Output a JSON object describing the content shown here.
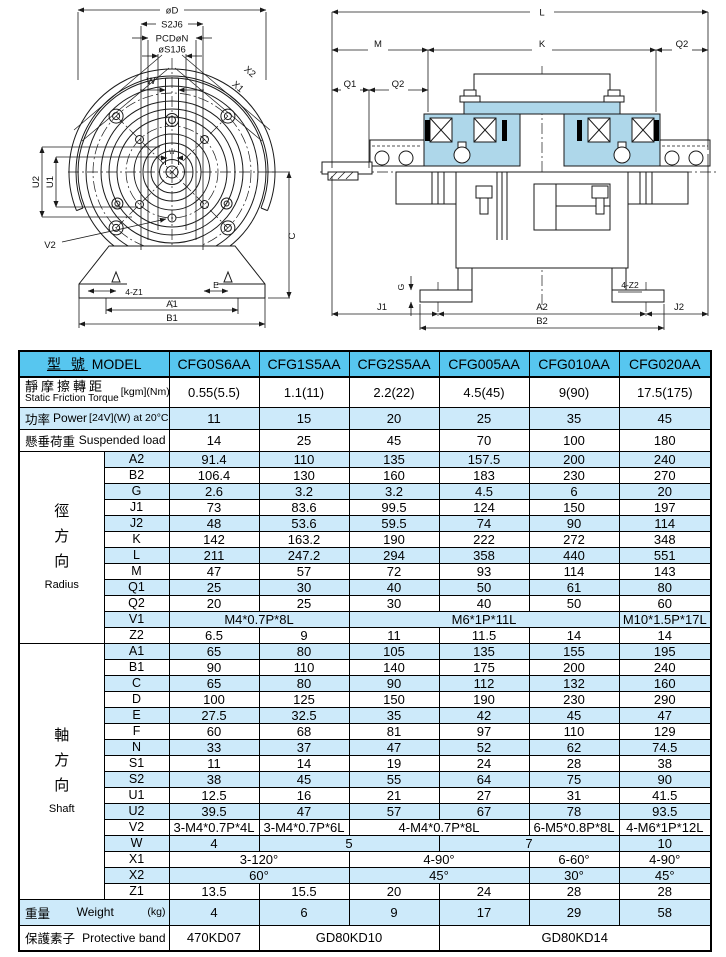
{
  "colors": {
    "header_blue": "#57c6ef",
    "row_blue": "#cdeafa",
    "drawing_fill": "#aed7ea"
  },
  "drawings": {
    "front_view": {
      "labels": {
        "od": "øD",
        "s2": "S2J6",
        "pcd": "PCDøN",
        "s1": "øS1J6",
        "w": "W",
        "w_small": "W",
        "x2": "X2",
        "x1": "X1",
        "u2": "U2",
        "u1": "U1",
        "v2": "V2",
        "c": "C",
        "z1": "4-Z1",
        "e": "E",
        "a1": "A1",
        "b1": "B1"
      }
    },
    "side_view": {
      "labels": {
        "l": "L",
        "m": "M",
        "k": "K",
        "q2_right": "Q2",
        "q1": "Q1",
        "q2_left": "Q2",
        "g": "G",
        "j1": "J1",
        "a2": "A2",
        "z2": "4-Z2",
        "j2": "J2",
        "b2": "B2"
      }
    }
  },
  "table": {
    "header": {
      "model_zh": "型 號",
      "model_en": "MODEL",
      "models": [
        "CFG0S6AA",
        "CFG1S5AA",
        "CFG2S5AA",
        "CFG005AA",
        "CFG010AA",
        "CFG020AA"
      ]
    },
    "spec_rows": [
      {
        "zh": "靜摩擦轉距",
        "en": "Static Friction Torque",
        "unit": "[kgm](Nm)",
        "two_line": true,
        "values": [
          "0.55(5.5)",
          "1.1(11)",
          "2.2(22)",
          "4.5(45)",
          "9(90)",
          "17.5(175)"
        ]
      },
      {
        "zh": "功率",
        "en": "Power",
        "unit": "[24V](W) at 20°C",
        "two_line": false,
        "values": [
          "11",
          "15",
          "20",
          "25",
          "35",
          "45"
        ]
      },
      {
        "zh": "懸垂荷重",
        "en": "Suspended load",
        "unit": "",
        "two_line": false,
        "values": [
          "14",
          "25",
          "45",
          "70",
          "100",
          "180"
        ]
      }
    ],
    "sections": [
      {
        "zh": "徑方向",
        "en": "Radius",
        "rows": [
          {
            "param": "A2",
            "cells": [
              [
                "91.4",
                1
              ],
              [
                "110",
                1
              ],
              [
                "135",
                1
              ],
              [
                "157.5",
                1
              ],
              [
                "200",
                1
              ],
              [
                "240",
                1
              ]
            ]
          },
          {
            "param": "B2",
            "cells": [
              [
                "106.4",
                1
              ],
              [
                "130",
                1
              ],
              [
                "160",
                1
              ],
              [
                "183",
                1
              ],
              [
                "230",
                1
              ],
              [
                "270",
                1
              ]
            ]
          },
          {
            "param": "G",
            "cells": [
              [
                "2.6",
                1
              ],
              [
                "3.2",
                1
              ],
              [
                "3.2",
                1
              ],
              [
                "4.5",
                1
              ],
              [
                "6",
                1
              ],
              [
                "20",
                1
              ]
            ]
          },
          {
            "param": "J1",
            "cells": [
              [
                "73",
                1
              ],
              [
                "83.6",
                1
              ],
              [
                "99.5",
                1
              ],
              [
                "124",
                1
              ],
              [
                "150",
                1
              ],
              [
                "197",
                1
              ]
            ]
          },
          {
            "param": "J2",
            "cells": [
              [
                "48",
                1
              ],
              [
                "53.6",
                1
              ],
              [
                "59.5",
                1
              ],
              [
                "74",
                1
              ],
              [
                "90",
                1
              ],
              [
                "114",
                1
              ]
            ]
          },
          {
            "param": "K",
            "cells": [
              [
                "142",
                1
              ],
              [
                "163.2",
                1
              ],
              [
                "190",
                1
              ],
              [
                "222",
                1
              ],
              [
                "272",
                1
              ],
              [
                "348",
                1
              ]
            ]
          },
          {
            "param": "L",
            "cells": [
              [
                "211",
                1
              ],
              [
                "247.2",
                1
              ],
              [
                "294",
                1
              ],
              [
                "358",
                1
              ],
              [
                "440",
                1
              ],
              [
                "551",
                1
              ]
            ]
          },
          {
            "param": "M",
            "cells": [
              [
                "47",
                1
              ],
              [
                "57",
                1
              ],
              [
                "72",
                1
              ],
              [
                "93",
                1
              ],
              [
                "114",
                1
              ],
              [
                "143",
                1
              ]
            ]
          },
          {
            "param": "Q1",
            "cells": [
              [
                "25",
                1
              ],
              [
                "30",
                1
              ],
              [
                "40",
                1
              ],
              [
                "50",
                1
              ],
              [
                "61",
                1
              ],
              [
                "80",
                1
              ]
            ]
          },
          {
            "param": "Q2",
            "cells": [
              [
                "20",
                1
              ],
              [
                "25",
                1
              ],
              [
                "30",
                1
              ],
              [
                "40",
                1
              ],
              [
                "50",
                1
              ],
              [
                "60",
                1
              ]
            ]
          },
          {
            "param": "V1",
            "cells": [
              [
                "M4*0.7P*8L",
                2
              ],
              [
                "M6*1P*11L",
                3
              ],
              [
                "M10*1.5P*17L",
                1
              ]
            ]
          },
          {
            "param": "Z2",
            "cells": [
              [
                "6.5",
                1
              ],
              [
                "9",
                1
              ],
              [
                "11",
                1
              ],
              [
                "11.5",
                1
              ],
              [
                "14",
                1
              ],
              [
                "14",
                1
              ]
            ]
          }
        ]
      },
      {
        "zh": "軸方向",
        "en": "Shaft",
        "rows": [
          {
            "param": "A1",
            "cells": [
              [
                "65",
                1
              ],
              [
                "80",
                1
              ],
              [
                "105",
                1
              ],
              [
                "135",
                1
              ],
              [
                "155",
                1
              ],
              [
                "195",
                1
              ]
            ]
          },
          {
            "param": "B1",
            "cells": [
              [
                "90",
                1
              ],
              [
                "110",
                1
              ],
              [
                "140",
                1
              ],
              [
                "175",
                1
              ],
              [
                "200",
                1
              ],
              [
                "240",
                1
              ]
            ]
          },
          {
            "param": "C",
            "cells": [
              [
                "65",
                1
              ],
              [
                "80",
                1
              ],
              [
                "90",
                1
              ],
              [
                "112",
                1
              ],
              [
                "132",
                1
              ],
              [
                "160",
                1
              ]
            ]
          },
          {
            "param": "D",
            "cells": [
              [
                "100",
                1
              ],
              [
                "125",
                1
              ],
              [
                "150",
                1
              ],
              [
                "190",
                1
              ],
              [
                "230",
                1
              ],
              [
                "290",
                1
              ]
            ]
          },
          {
            "param": "E",
            "cells": [
              [
                "27.5",
                1
              ],
              [
                "32.5",
                1
              ],
              [
                "35",
                1
              ],
              [
                "42",
                1
              ],
              [
                "45",
                1
              ],
              [
                "47",
                1
              ]
            ]
          },
          {
            "param": "F",
            "cells": [
              [
                "60",
                1
              ],
              [
                "68",
                1
              ],
              [
                "81",
                1
              ],
              [
                "97",
                1
              ],
              [
                "110",
                1
              ],
              [
                "129",
                1
              ]
            ]
          },
          {
            "param": "N",
            "cells": [
              [
                "33",
                1
              ],
              [
                "37",
                1
              ],
              [
                "47",
                1
              ],
              [
                "52",
                1
              ],
              [
                "62",
                1
              ],
              [
                "74.5",
                1
              ]
            ]
          },
          {
            "param": "S1",
            "cells": [
              [
                "11",
                1
              ],
              [
                "14",
                1
              ],
              [
                "19",
                1
              ],
              [
                "24",
                1
              ],
              [
                "28",
                1
              ],
              [
                "38",
                1
              ]
            ]
          },
          {
            "param": "S2",
            "cells": [
              [
                "38",
                1
              ],
              [
                "45",
                1
              ],
              [
                "55",
                1
              ],
              [
                "64",
                1
              ],
              [
                "75",
                1
              ],
              [
                "90",
                1
              ]
            ]
          },
          {
            "param": "U1",
            "cells": [
              [
                "12.5",
                1
              ],
              [
                "16",
                1
              ],
              [
                "21",
                1
              ],
              [
                "27",
                1
              ],
              [
                "31",
                1
              ],
              [
                "41.5",
                1
              ]
            ]
          },
          {
            "param": "U2",
            "cells": [
              [
                "39.5",
                1
              ],
              [
                "47",
                1
              ],
              [
                "57",
                1
              ],
              [
                "67",
                1
              ],
              [
                "78",
                1
              ],
              [
                "93.5",
                1
              ]
            ]
          },
          {
            "param": "V2",
            "cells": [
              [
                "3-M4*0.7P*4L",
                1
              ],
              [
                "3-M4*0.7P*6L",
                1
              ],
              [
                "4-M4*0.7P*8L",
                2
              ],
              [
                "6-M5*0.8P*8L",
                1
              ],
              [
                "4-M6*1P*12L",
                1
              ]
            ]
          },
          {
            "param": "W",
            "cells": [
              [
                "4",
                1
              ],
              [
                "5",
                2
              ],
              [
                "7",
                2
              ],
              [
                "10",
                1
              ]
            ]
          },
          {
            "param": "X1",
            "cells": [
              [
                "3-120°",
                2
              ],
              [
                "4-90°",
                2
              ],
              [
                "6-60°",
                1
              ],
              [
                "4-90°",
                1
              ]
            ]
          },
          {
            "param": "X2",
            "cells": [
              [
                "60°",
                2
              ],
              [
                "45°",
                2
              ],
              [
                "30°",
                1
              ],
              [
                "45°",
                1
              ]
            ]
          },
          {
            "param": "Z1",
            "cells": [
              [
                "13.5",
                1
              ],
              [
                "15.5",
                1
              ],
              [
                "20",
                1
              ],
              [
                "24",
                1
              ],
              [
                "28",
                1
              ],
              [
                "28",
                1
              ]
            ]
          }
        ]
      }
    ],
    "weight": {
      "zh": "重量",
      "en": "Weight",
      "unit": "(kg)",
      "values": [
        "4",
        "6",
        "9",
        "17",
        "29",
        "58"
      ]
    },
    "protective": {
      "zh": "保護素子",
      "en": "Protective band",
      "cells": [
        [
          "470KD07",
          1
        ],
        [
          "GD80KD10",
          2
        ],
        [
          "GD80KD14",
          3
        ]
      ]
    }
  }
}
